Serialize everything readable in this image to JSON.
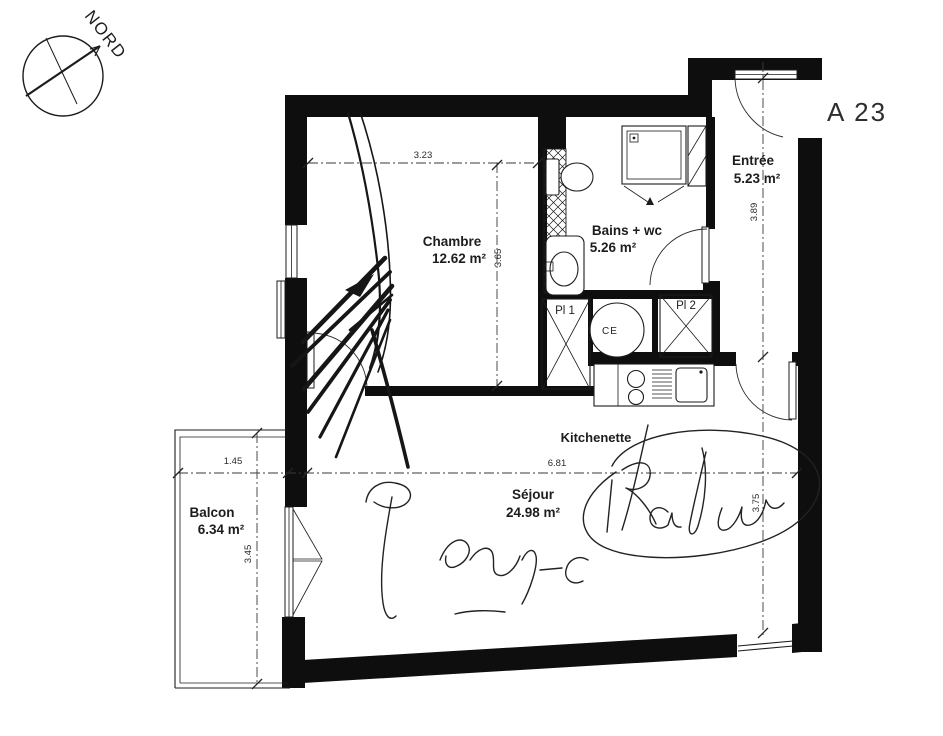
{
  "meta": {
    "unit_label": "A 23"
  },
  "compass": {
    "label": "NORD"
  },
  "rooms": {
    "chambre": {
      "name": "Chambre",
      "area": "12.62 m²"
    },
    "bains": {
      "name": "Bains + wc",
      "area": "5.26 m²"
    },
    "entree": {
      "name": "Entrée",
      "area": "5.23 m²"
    },
    "sejour": {
      "name": "Séjour",
      "area": "24.98 m²"
    },
    "balcon": {
      "name": "Balcon",
      "area": "6.34 m²"
    },
    "kitchenette": {
      "name": "Kitchenette"
    }
  },
  "storage": {
    "pl1": "Pl 1",
    "pl2": "Pl 2",
    "water_heater": "CE"
  },
  "dimensions_m": {
    "chambre_width": "3.23",
    "chambre_depth": "3.65",
    "entree_depth": "3.89",
    "sejour_width": "6.81",
    "sejour_depth": "3.75",
    "balcon_width": "1.45",
    "balcon_depth": "3.45"
  },
  "colors": {
    "ink": "#1c1c1c",
    "wall": "#0e0e0e",
    "paper": "#ffffff"
  }
}
